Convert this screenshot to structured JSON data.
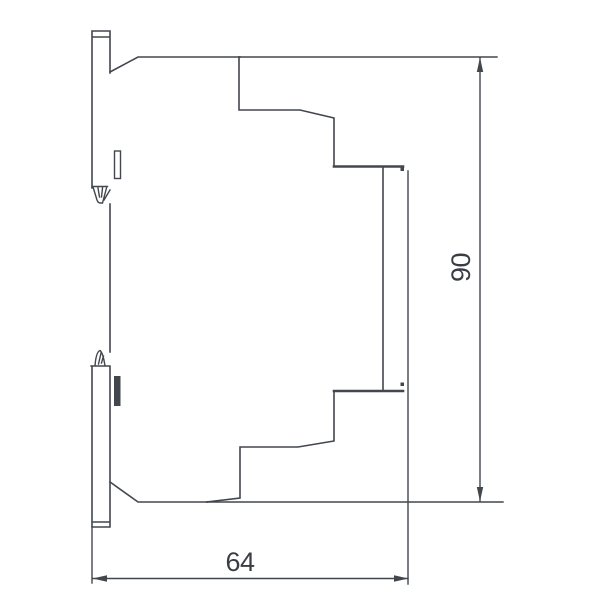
{
  "drawing": {
    "type": "technical-dimension-drawing",
    "view": "din-rail-module-side-profile",
    "dimensions": {
      "width": {
        "label": "64"
      },
      "height": {
        "label": "90"
      }
    }
  },
  "colors": {
    "line": "#42464d",
    "fill": "#2f3338",
    "text": "#3a3d43",
    "background": "#ffffff"
  }
}
